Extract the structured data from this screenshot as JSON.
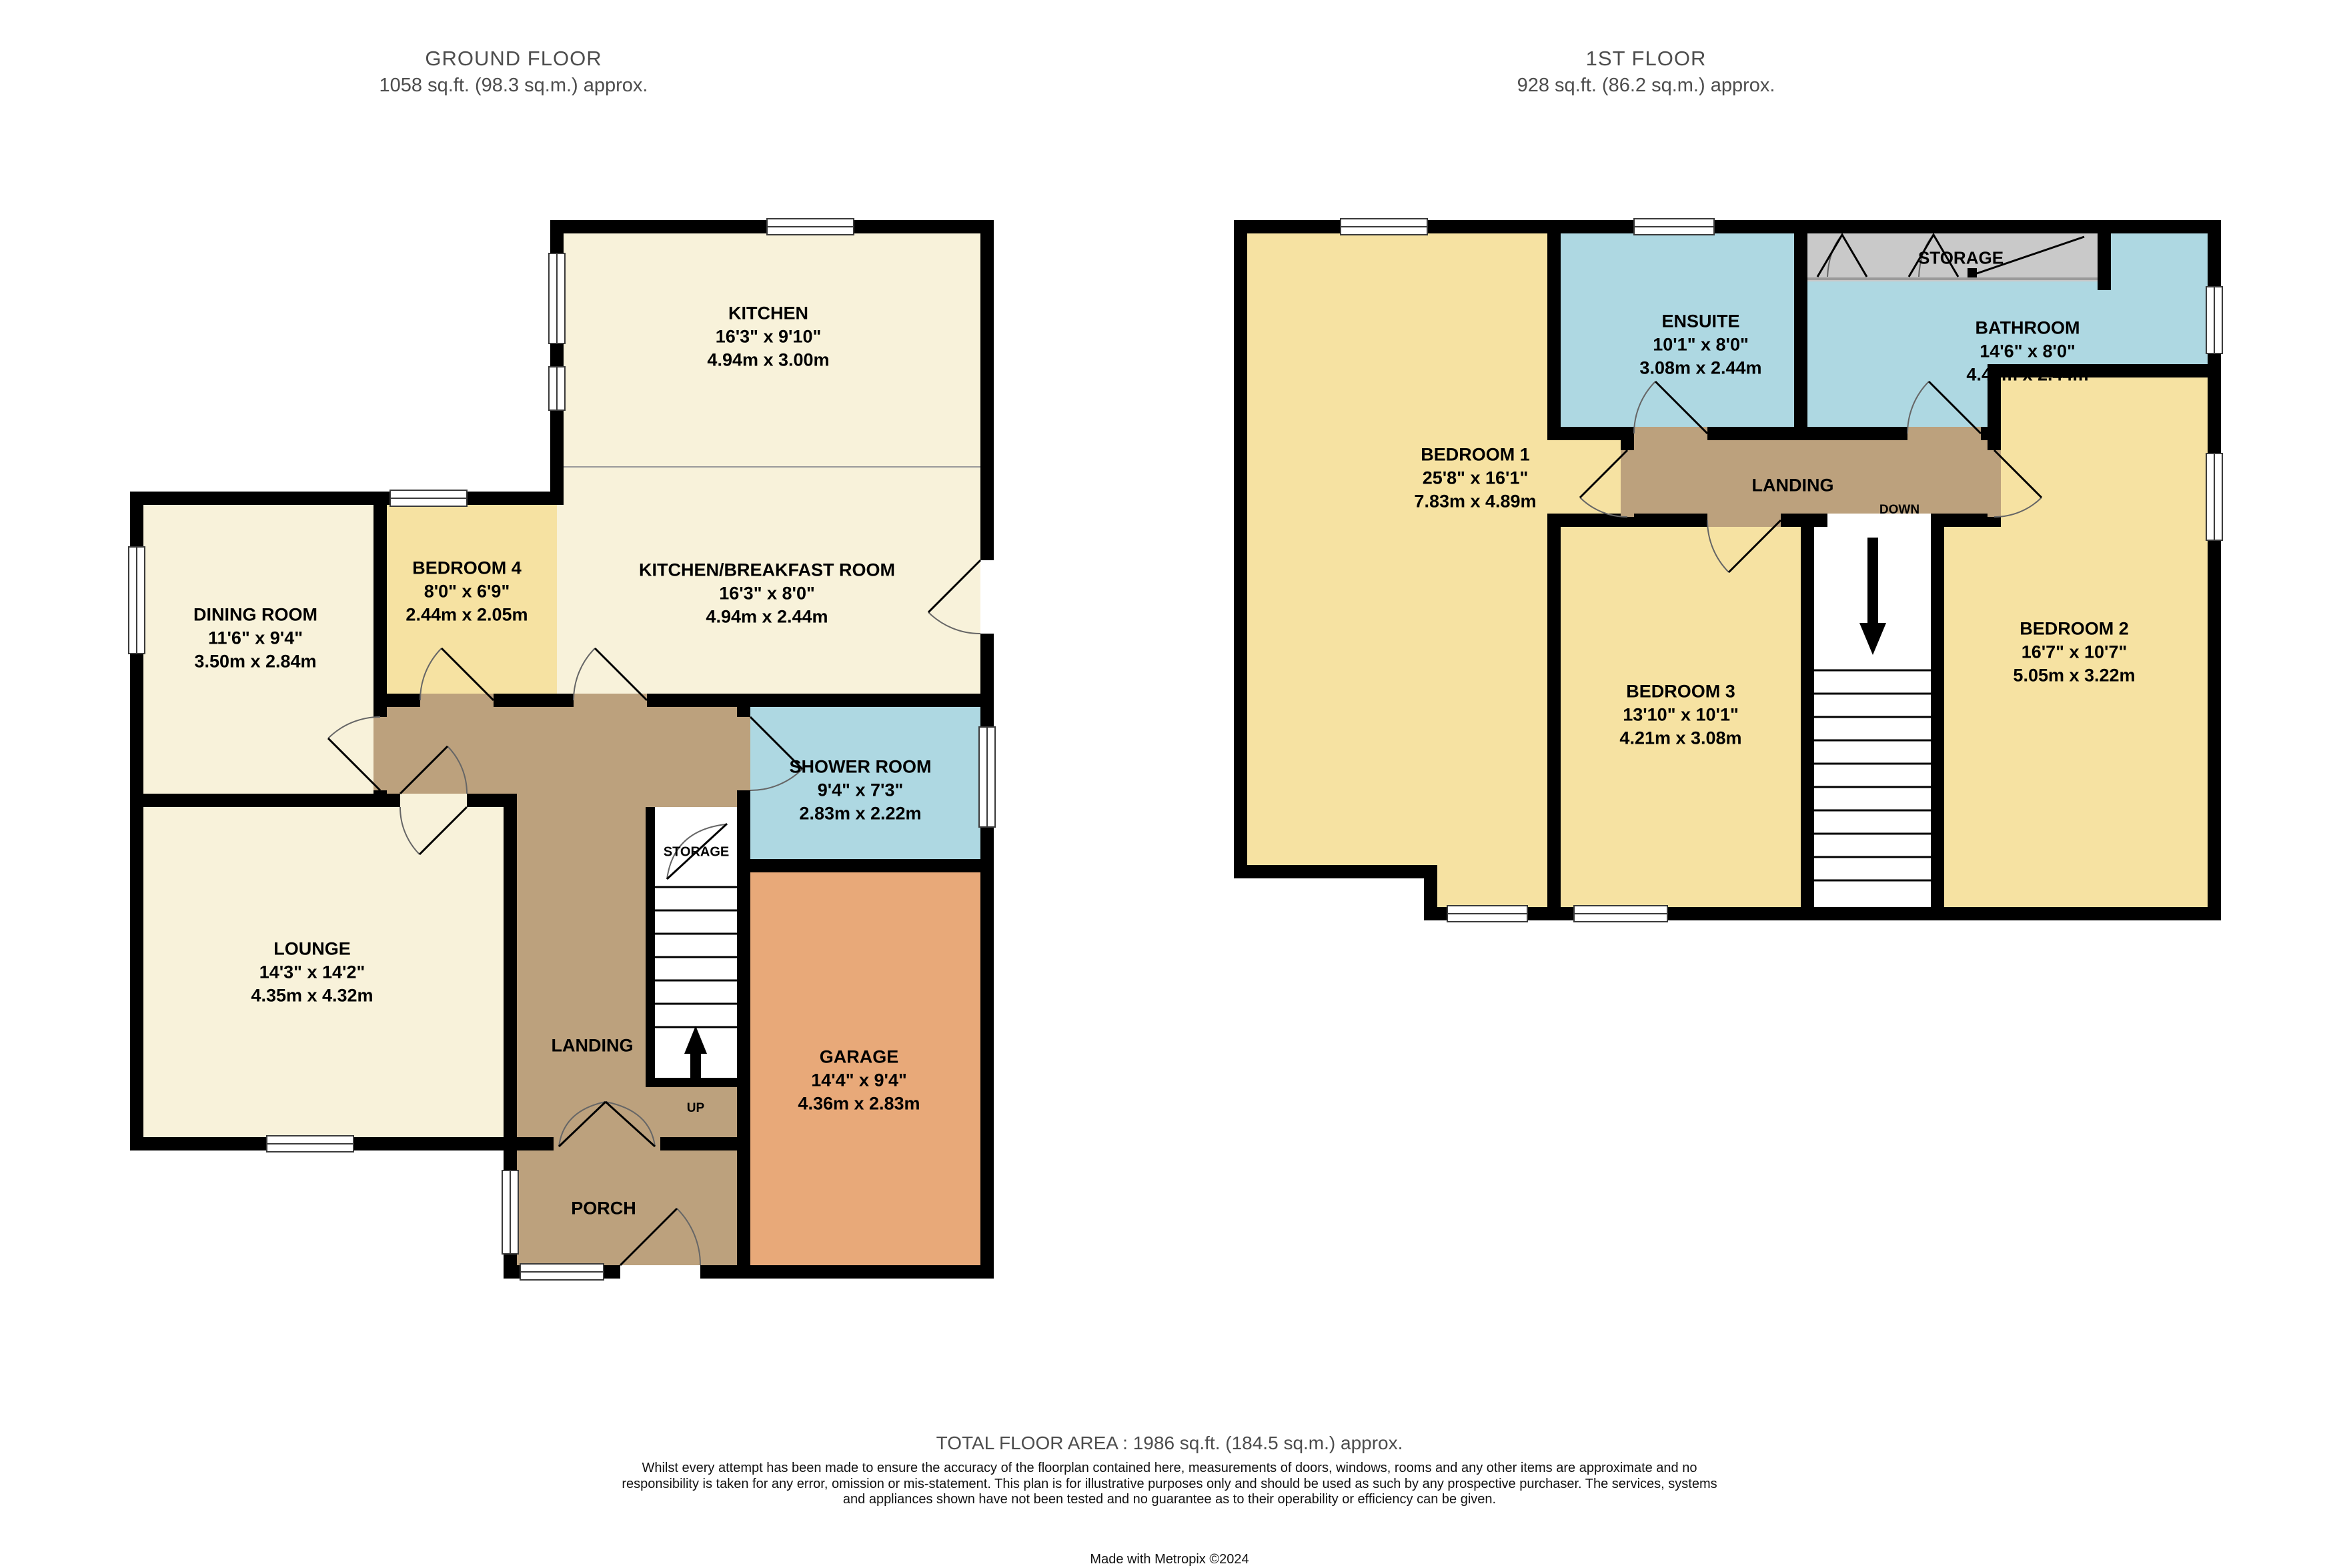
{
  "ground_floor": {
    "title": "GROUND FLOOR",
    "subtitle": "1058 sq.ft. (98.3 sq.m.) approx.",
    "rooms": {
      "kitchen": {
        "name": "KITCHEN",
        "imperial": "16'3\"  x 9'10\"",
        "metric": "4.94m  x 3.00m"
      },
      "kitchen_breakfast": {
        "name": "KITCHEN/BREAKFAST ROOM",
        "imperial": "16'3\"  x 8'0\"",
        "metric": "4.94m  x 2.44m"
      },
      "bedroom4": {
        "name": "BEDROOM 4",
        "imperial": "8'0\"  x 6'9\"",
        "metric": "2.44m  x 2.05m"
      },
      "dining": {
        "name": "DINING ROOM",
        "imperial": "11'6\"  x 9'4\"",
        "metric": "3.50m  x 2.84m"
      },
      "shower": {
        "name": "SHOWER ROOM",
        "imperial": "9'4\"  x 7'3\"",
        "metric": "2.83m  x 2.22m"
      },
      "lounge": {
        "name": "LOUNGE",
        "imperial": "14'3\"  x 14'2\"",
        "metric": "4.35m  x 4.32m"
      },
      "garage": {
        "name": "GARAGE",
        "imperial": "14'4\"  x 9'4\"",
        "metric": "4.36m  x 2.83m"
      },
      "landing": {
        "name": "LANDING"
      },
      "storage": {
        "name": "STORAGE"
      },
      "porch": {
        "name": "PORCH"
      },
      "stairs_direction": "UP"
    }
  },
  "first_floor": {
    "title": "1ST FLOOR",
    "subtitle": "928 sq.ft. (86.2 sq.m.) approx.",
    "rooms": {
      "bedroom1": {
        "name": "BEDROOM 1",
        "imperial": "25'8\"  x 16'1\"",
        "metric": "7.83m  x 4.89m"
      },
      "bedroom2": {
        "name": "BEDROOM 2",
        "imperial": "16'7\"  x 10'7\"",
        "metric": "5.05m  x 3.22m"
      },
      "bedroom3": {
        "name": "BEDROOM 3",
        "imperial": "13'10\"  x 10'1\"",
        "metric": "4.21m  x 3.08m"
      },
      "ensuite": {
        "name": "ENSUITE",
        "imperial": "10'1\"  x 8'0\"",
        "metric": "3.08m  x 2.44m"
      },
      "bathroom": {
        "name": "BATHROOM",
        "imperial": "14'6\"  x 8'0\"",
        "metric": "4.43m  x 2.44m"
      },
      "storage": {
        "name": "STORAGE"
      },
      "landing": {
        "name": "LANDING"
      },
      "stairs_direction": "DOWN"
    }
  },
  "footer": {
    "total": "TOTAL FLOOR AREA : 1986 sq.ft. (184.5 sq.m.) approx.",
    "disclaimer": "Whilst every attempt has been made to ensure the accuracy of the floorplan contained here, measurements of doors, windows, rooms and any other items are approximate and no responsibility is taken for any error, omission or mis-statement. This plan is for illustrative purposes only and should be used as such by any prospective purchaser. The services, systems and appliances shown have not been tested and no guarantee as to their operability or efficiency can be given.",
    "credit": "Made with Metropix ©2024"
  },
  "colors": {
    "cream": "#f8f2da",
    "yellow": "#f6e2a2",
    "tan": "#bca17d",
    "orange": "#e8a979",
    "blue": "#aed8e2",
    "storage_gray": "#c9c9c9",
    "wall": "#000000",
    "title_text": "#4d4d4d"
  }
}
